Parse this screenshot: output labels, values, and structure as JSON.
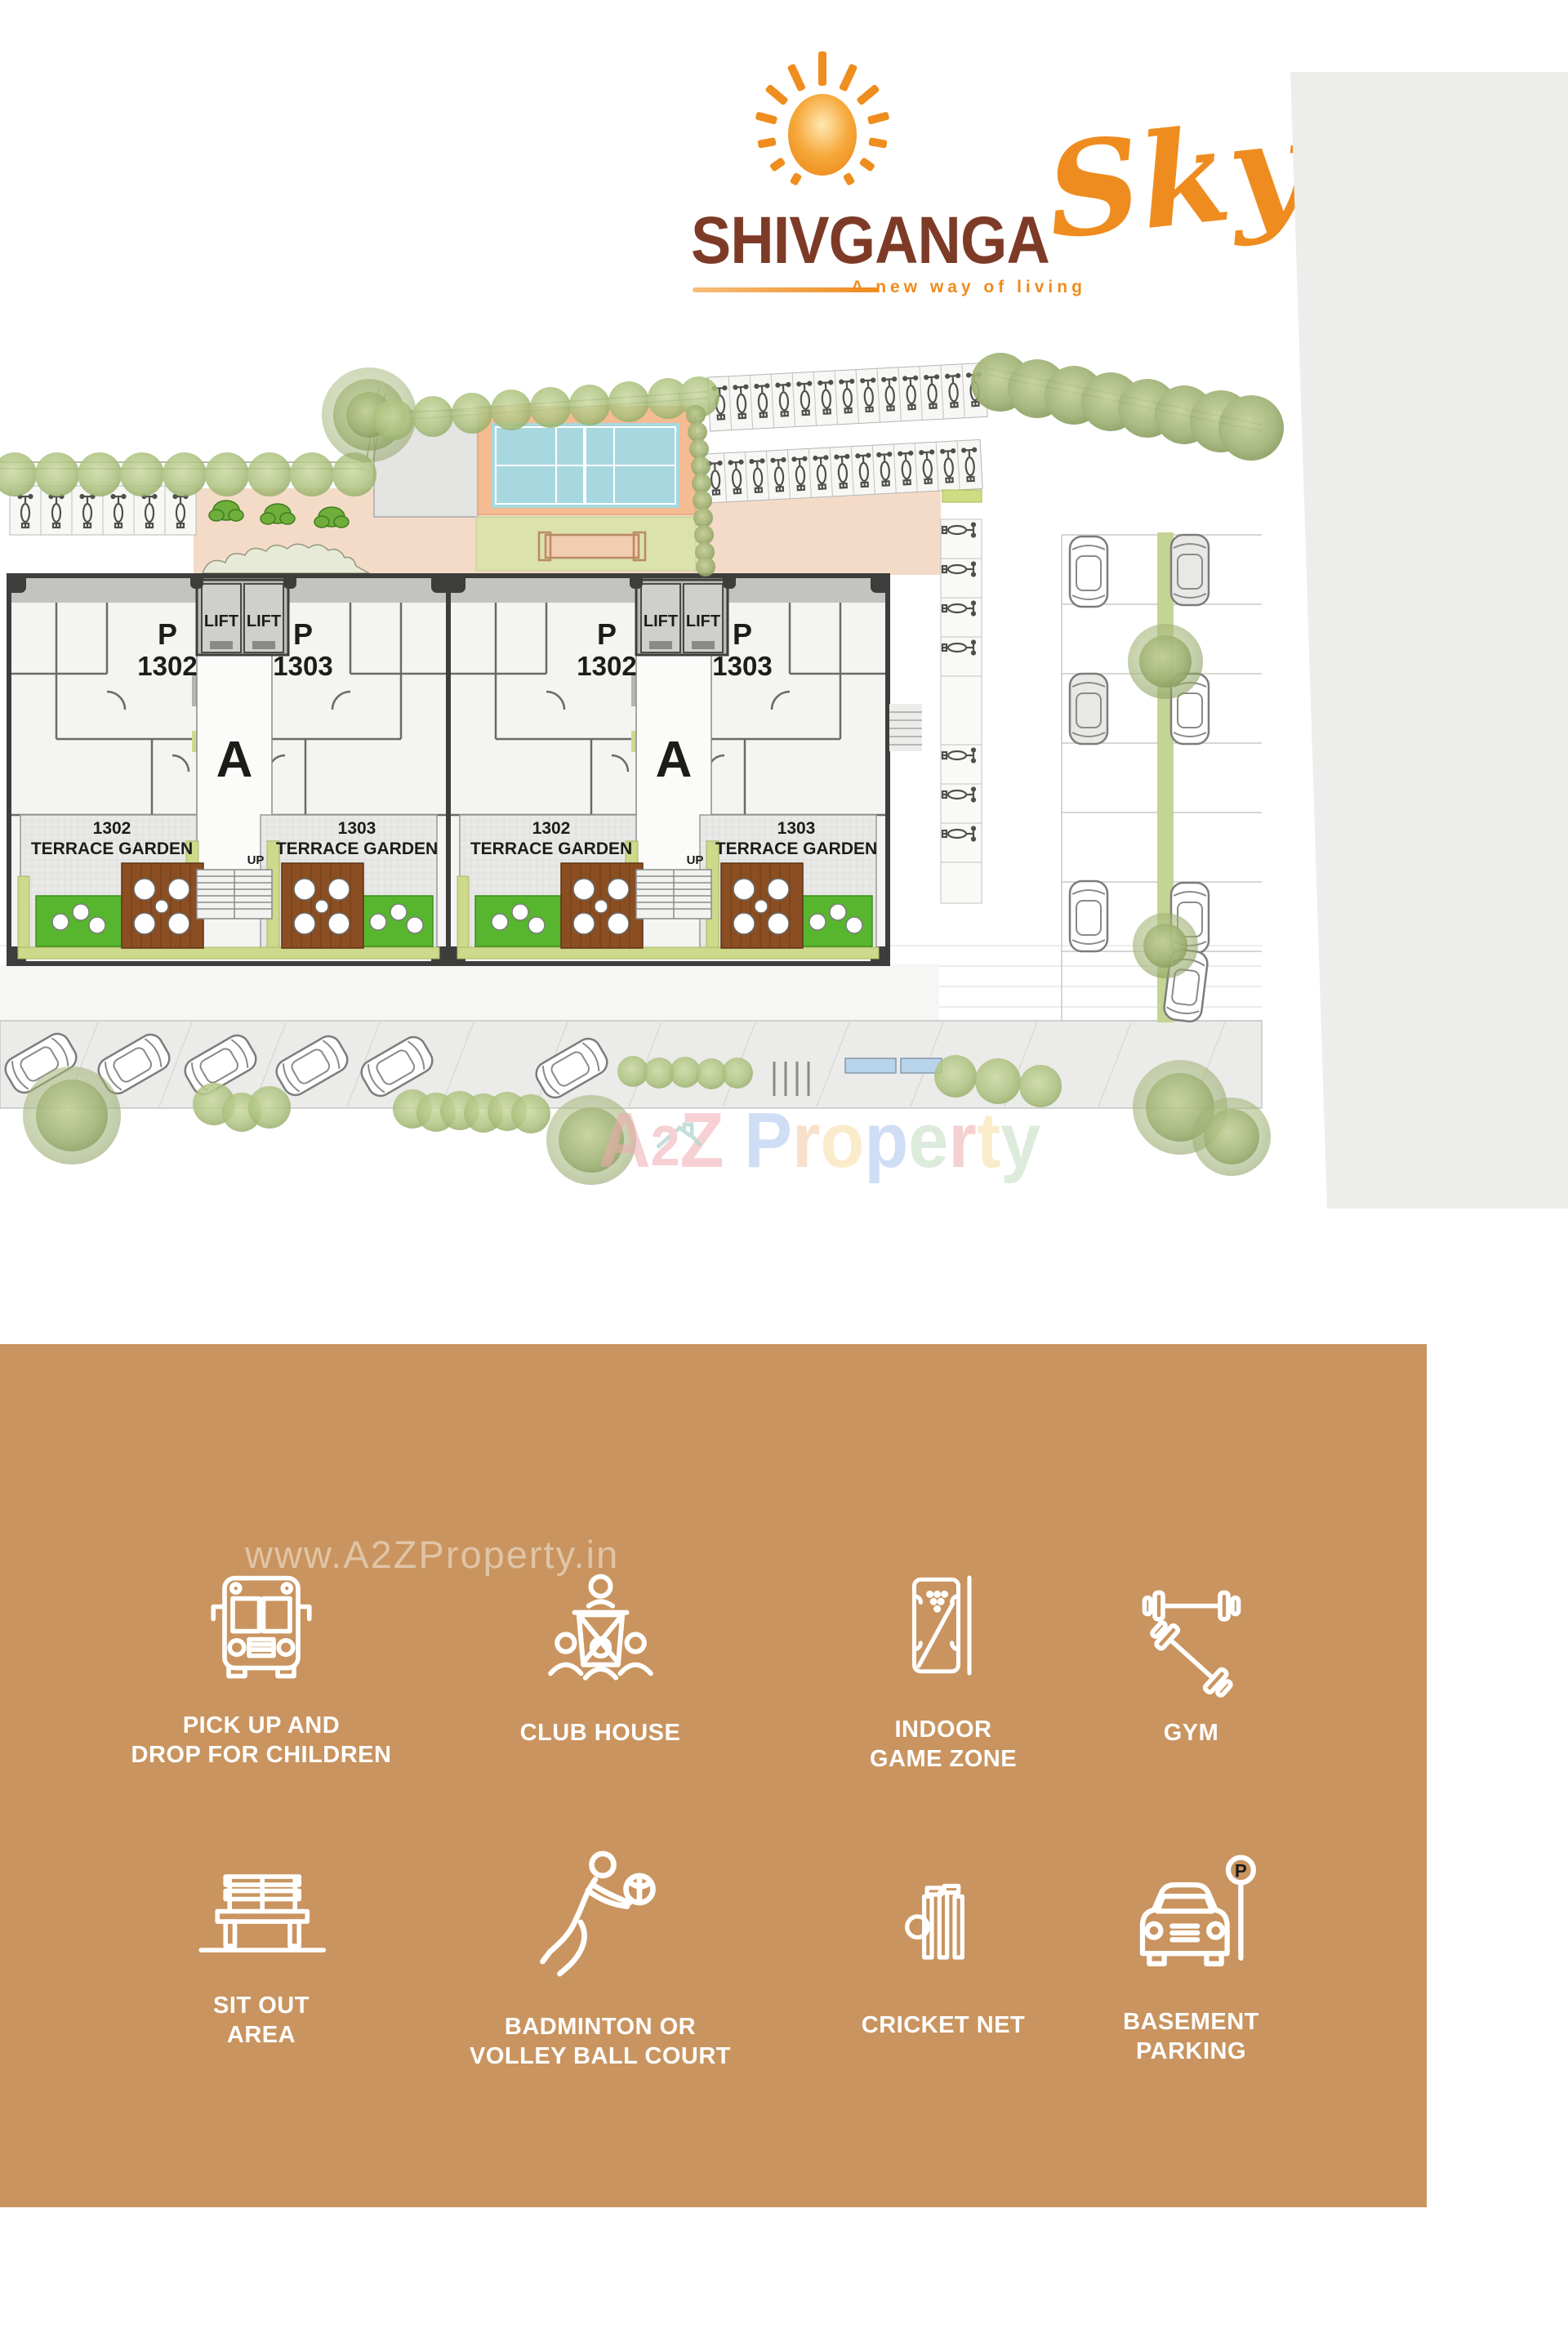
{
  "logo": {
    "brand": "SHIVGANGA",
    "script": "Sky",
    "tagline": "A new way of living"
  },
  "plan": {
    "p": "P",
    "u1302": "1302",
    "u1303": "1303",
    "lift": "LIFT",
    "block": "A",
    "terrace": "TERRACE GARDEN",
    "up": "UP"
  },
  "watermarks": {
    "site": "www.A2ZProperty.in",
    "center_letters": [
      "A",
      "2",
      "Z",
      "P",
      "r",
      "o",
      "p",
      "e",
      "r",
      "t",
      "y"
    ]
  },
  "amenities": {
    "p_sign": "P",
    "items": [
      {
        "icon": "bus-icon",
        "line1": "PICK UP AND",
        "line2": "DROP FOR CHILDREN"
      },
      {
        "icon": "club-house-icon",
        "line1": "CLUB HOUSE",
        "line2": ""
      },
      {
        "icon": "billiards-icon",
        "line1": "INDOOR",
        "line2": "GAME ZONE"
      },
      {
        "icon": "gym-icon",
        "line1": "GYM",
        "line2": ""
      },
      {
        "icon": "bench-icon",
        "line1": "SIT OUT",
        "line2": "AREA"
      },
      {
        "icon": "volleyball-icon",
        "line1": "BADMINTON OR",
        "line2": "VOLLEY BALL COURT"
      },
      {
        "icon": "cricket-icon",
        "line1": "CRICKET NET",
        "line2": ""
      },
      {
        "icon": "parking-icon",
        "line1": "BASEMENT",
        "line2": "PARKING"
      }
    ]
  },
  "colors": {
    "accent_orange": "#ef8c1f",
    "brand_brown": "#7d3b27",
    "panel_tan": "#c9945f",
    "court_blue": "#a7d8df",
    "court_salmon": "#f5bb92",
    "lawn_green": "#57b62e",
    "deck_brown": "#8a4e22",
    "olive_planter": "#cdd98b",
    "plaza_pink": "#f4dbc8",
    "tree_green": "#a9bf7d",
    "gray_area": "#ededeb"
  }
}
